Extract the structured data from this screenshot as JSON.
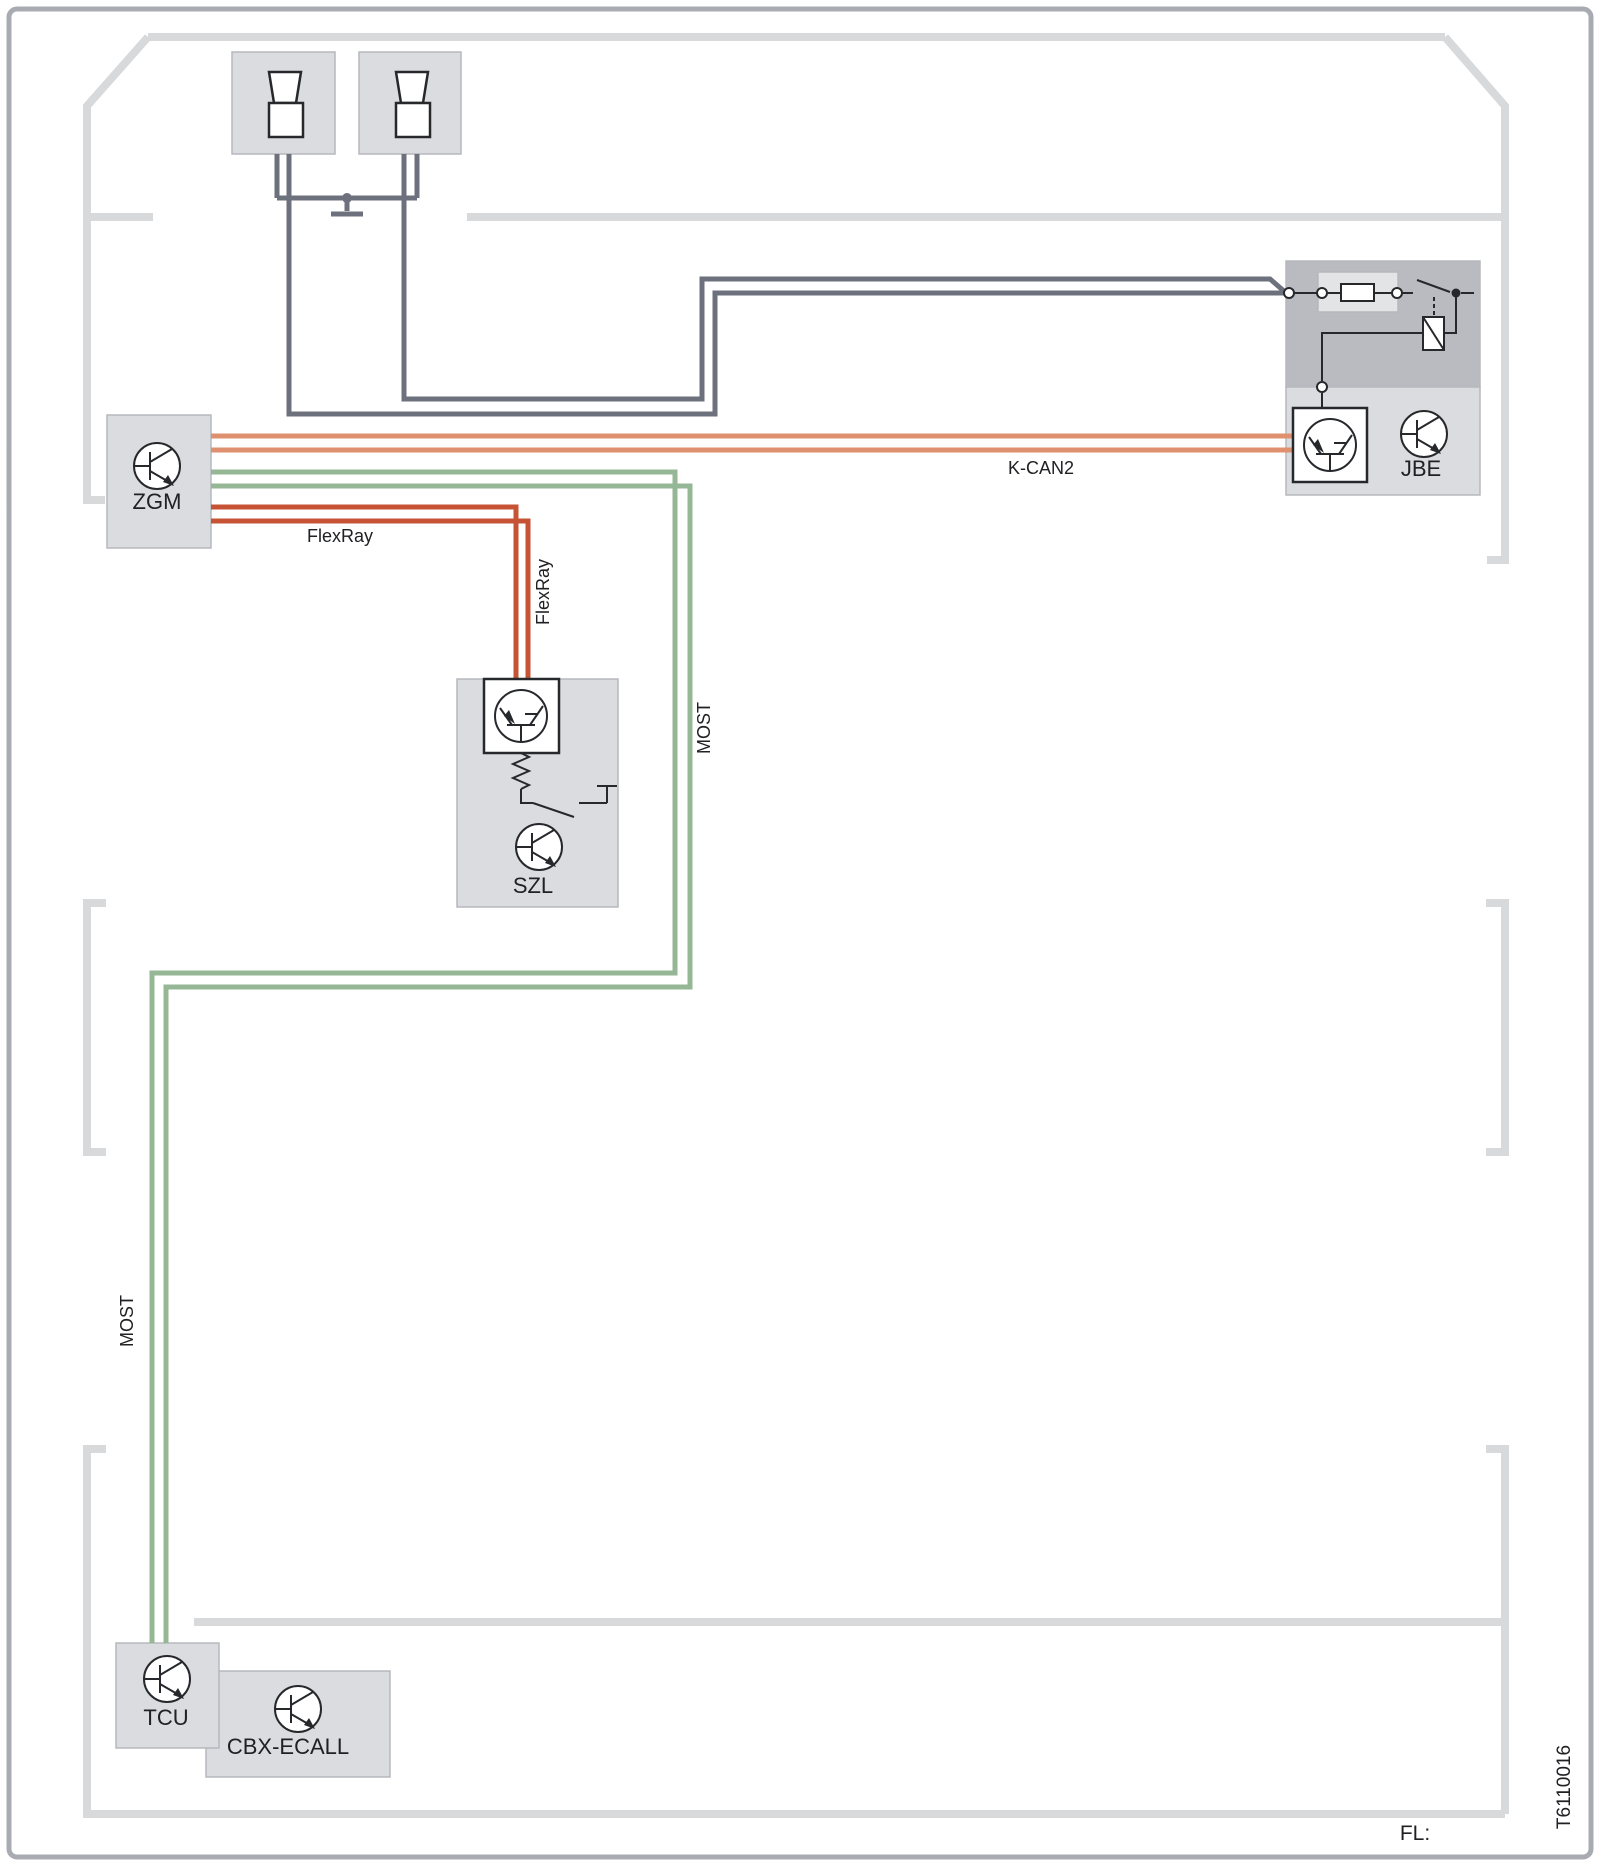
{
  "diagram": {
    "modules": {
      "zgm": {
        "label": "ZGM"
      },
      "jbe": {
        "label": "JBE"
      },
      "szl": {
        "label": "SZL"
      },
      "tcu": {
        "label": "TCU"
      },
      "cbx_ecall": {
        "label": "CBX-ECALL"
      }
    },
    "buses": {
      "kcan2": {
        "label": "K-CAN2",
        "color": "#DF906E"
      },
      "flexray": {
        "label": "FlexRay",
        "color": "#C65434"
      },
      "most": {
        "label": "MOST",
        "color": "#95B795"
      },
      "discrete_wire": {
        "color": "#6D717E"
      }
    },
    "symbols": [
      "horn-icon",
      "ground-icon",
      "fuse-icon",
      "switch-icon",
      "relay-coil-icon",
      "connector-terminal-icon",
      "control-unit-transistor-icon",
      "bus-interface-icon",
      "clock-spring-icon"
    ],
    "footer": {
      "label": "FL:",
      "drawing_number": "T6110016"
    },
    "colors": {
      "car_outline": "#D8D9DB",
      "frame_border": "#A8ACB2",
      "module_fill": "#DBDCDF",
      "module_stroke": "#B5B8BD",
      "jbe_inner_fill": "#B9BBC0",
      "fuse_field_fill": "#E3E4E6",
      "symbol_stroke": "#26282C",
      "footer_text": "#B5B9BF",
      "drawing_number_text": "#9BA0A8"
    }
  }
}
